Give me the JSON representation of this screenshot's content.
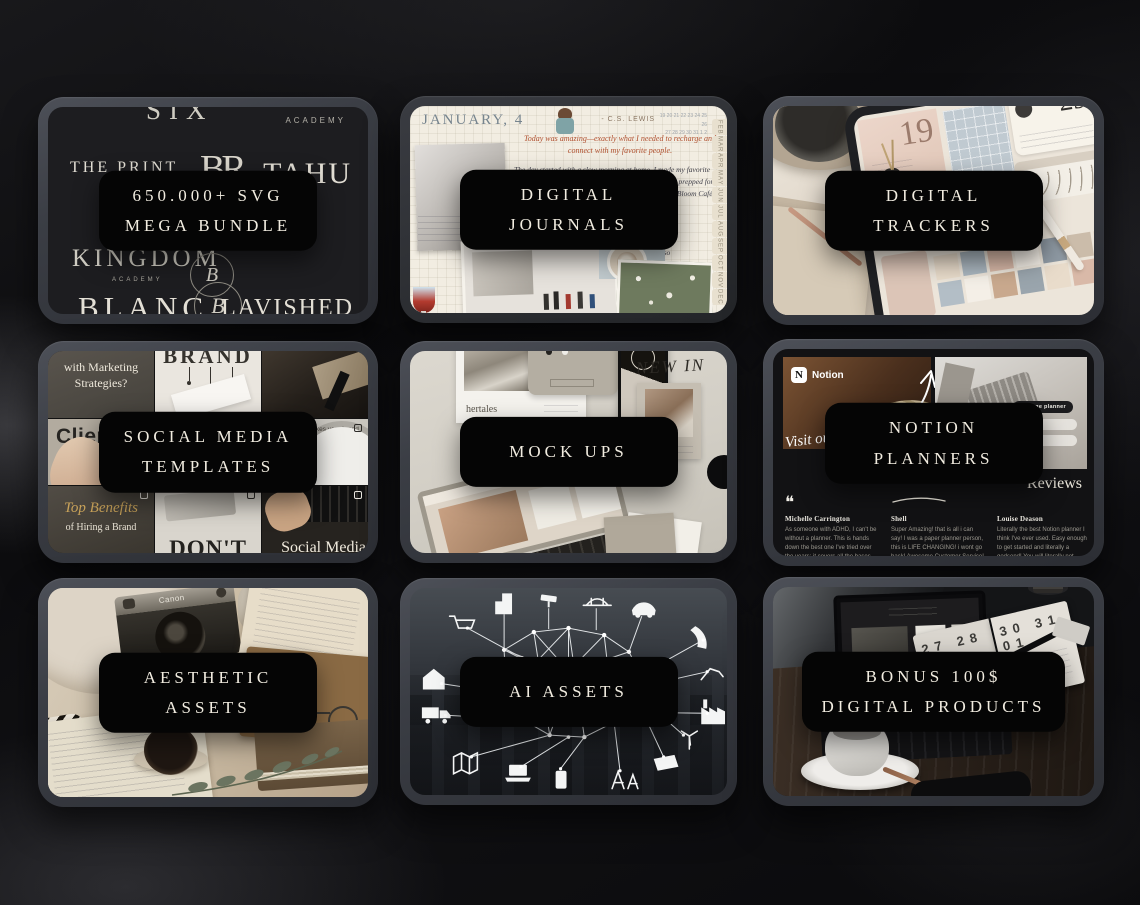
{
  "colors": {
    "background": "#0b0b0d",
    "tablet_frame": "#3f424a",
    "banner_bg": "#050505",
    "banner_text": "#f1ece0"
  },
  "tiles": [
    {
      "id": "svg-mega-bundle",
      "label": [
        "650.000+ SVG",
        "MEGA BUNDLE"
      ],
      "logos": {
        "six": "SIX",
        "academy": "ACADEMY",
        "the_print": "THE PRINT",
        "avenue": "Avenue",
        "br": "BR",
        "tahu": "TAHU",
        "kingdom": "KINGDOM",
        "kingdom_sub": "ACADEMY",
        "monogram": "B",
        "blanc": "BLANC",
        "lavished": "LAVISHED"
      }
    },
    {
      "id": "digital-journals",
      "label": [
        "DIGITAL",
        "JOURNALS"
      ],
      "journal": {
        "header": "JANUARY, 4",
        "quote_author": "- C.S. LEWIS",
        "dates_row1": "19 20 21 22 23 24 25 26",
        "dates_row2": "27 28 29 30 31 1 2",
        "intro": "Today was amazing—exactly what I needed to recharge and connect with my favorite people.",
        "body1": "The day started with a slow morning at home. I made my favorite latte, enjoyed the quiet while journaling, and mentally prepped for the fun ahead. Around noon, I met up with the girls at Bloom Café. The laughter started the moment we saw each other.",
        "body2": "was stunning—vibrant colors, bold textures, and so much emotion.",
        "body3": "We wandered around, sharing our thoughts on each piece and snapping fun photos along the way.",
        "body4": "One painting really spoke to me—a burst of colors that reminded me of the unpredictability of life.",
        "body5": "As the sun began to set, we decided",
        "months": [
          "FEB",
          "MAR",
          "APR",
          "MAY",
          "JUN",
          "JUL",
          "AUG",
          "SEP",
          "OCT",
          "NOV",
          "DEC"
        ]
      }
    },
    {
      "id": "digital-trackers",
      "label": [
        "DIGITAL",
        "TRACKERS"
      ],
      "tracker": {
        "day": "29",
        "cover": "19"
      }
    },
    {
      "id": "social-media-templates",
      "label": [
        "SOCIAL MEDIA",
        "TEMPLATES"
      ],
      "cells": {
        "marketing": "with Marketing Strategies?",
        "brand": "BRAND",
        "client": "Client",
        "client2": "RE",
        "tribe_small": "How TRIBE makes your brand",
        "tribe_big": "Stand Out",
        "benefits_script": "Top Benefits",
        "benefits_sub": "of Hiring a Brand",
        "dont": "DON'T",
        "social": "Social Media"
      }
    },
    {
      "id": "mock-ups",
      "label": [
        "MOCK UPS"
      ],
      "texts": {
        "brand": "hertales",
        "poster": "NEW IN"
      }
    },
    {
      "id": "notion-planners",
      "label": [
        "NOTION",
        "PLANNERS"
      ],
      "notion": {
        "brand": "Notion",
        "brand_letter": "N",
        "script": "Visit our Shop",
        "badge": "60 page planner",
        "reviews_heading": "Reviews",
        "quote": "❝",
        "reviews": [
          {
            "name": "Michelle Carrington",
            "text": "As someone with ADHD, I can't be without a planner. This is hands down the best one I've tried over the years; it covers all the bases, it's intuitive, provides"
          },
          {
            "name": "Shell",
            "text": "Super Amazing! that is all i can say! I was a paper planner person, this is LIFE CHANGING! i wont go back! Awesome Customer Service! If you are"
          },
          {
            "name": "Louise Deason",
            "text": "Literally the best Notion planner I think I've ever used. Easy enough to get started and literally a godsend! You will literally not regret purchasing"
          }
        ]
      }
    },
    {
      "id": "aesthetic-assets",
      "label": [
        "AESTHETIC",
        "ASSETS"
      ],
      "camera_brand": "Canon"
    },
    {
      "id": "ai-assets",
      "label": [
        "AI ASSETS"
      ]
    },
    {
      "id": "bonus-digital-products",
      "label": [
        "BONUS 100$",
        "DIGITAL PRODUCTS"
      ],
      "planner": {
        "left_dates": "27 28 29",
        "right_dates": "30 31 01"
      }
    }
  ]
}
